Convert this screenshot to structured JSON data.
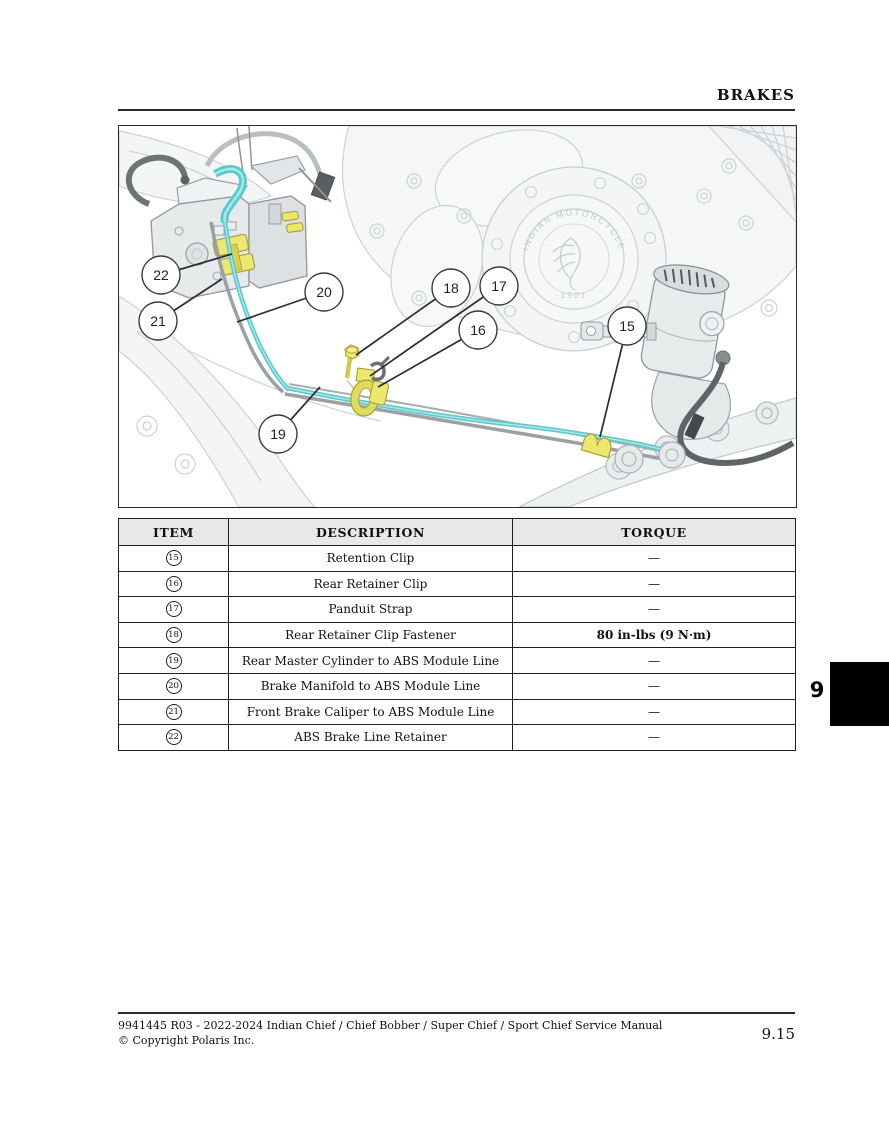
{
  "header": {
    "title": "BRAKES"
  },
  "chapter_tab": {
    "number": "9"
  },
  "footer": {
    "line1": "9941445 R03 - 2022-2024 Indian Chief / Chief Bobber / Super Chief / Sport Chief Service Manual",
    "line2": "© Copyright Polaris Inc.",
    "page_number": "9.15"
  },
  "diagram": {
    "logo_arc_text": "INDIAN MOTORCYCLE",
    "logo_year": "1901",
    "colors": {
      "brake_line_cyan": "#5ecdd1",
      "clip_yellow": "#ece76e",
      "clip_yellow_stroke": "#a8a233",
      "hose_dark": "#5f6467",
      "engine_light": "#ccd1d4"
    },
    "callouts": [
      {
        "label": "22",
        "cx": 42,
        "cy": 149,
        "tx": 113,
        "ty": 128
      },
      {
        "label": "21",
        "cx": 39,
        "cy": 195,
        "tx": 103,
        "ty": 153
      },
      {
        "label": "20",
        "cx": 205,
        "cy": 166,
        "tx": 118,
        "ty": 196
      },
      {
        "label": "18",
        "cx": 332,
        "cy": 162,
        "tx": 237,
        "ty": 229
      },
      {
        "label": "17",
        "cx": 380,
        "cy": 160,
        "tx": 251,
        "ty": 250
      },
      {
        "label": "16",
        "cx": 359,
        "cy": 204,
        "tx": 259,
        "ty": 261
      },
      {
        "label": "15",
        "cx": 508,
        "cy": 200,
        "tx": 481,
        "ty": 311
      },
      {
        "label": "19",
        "cx": 159,
        "cy": 308,
        "tx": 201,
        "ty": 261
      }
    ]
  },
  "table": {
    "headers": [
      "ITEM",
      "DESCRIPTION",
      "TORQUE"
    ],
    "rows": [
      {
        "item": "15",
        "description": "Retention Clip",
        "torque": "—",
        "torque_bold": false
      },
      {
        "item": "16",
        "description": "Rear Retainer Clip",
        "torque": "—",
        "torque_bold": false
      },
      {
        "item": "17",
        "description": "Panduit Strap",
        "torque": "—",
        "torque_bold": false
      },
      {
        "item": "18",
        "description": "Rear Retainer Clip Fastener",
        "torque": "80 in-lbs (9 N·m)",
        "torque_bold": true
      },
      {
        "item": "19",
        "description": "Rear Master Cylinder to ABS Module Line",
        "torque": "—",
        "torque_bold": false
      },
      {
        "item": "20",
        "description": "Brake Manifold to ABS Module Line",
        "torque": "—",
        "torque_bold": false
      },
      {
        "item": "21",
        "description": "Front Brake Caliper to ABS Module Line",
        "torque": "—",
        "torque_bold": false
      },
      {
        "item": "22",
        "description": "ABS Brake Line Retainer",
        "torque": "—",
        "torque_bold": false
      }
    ]
  }
}
